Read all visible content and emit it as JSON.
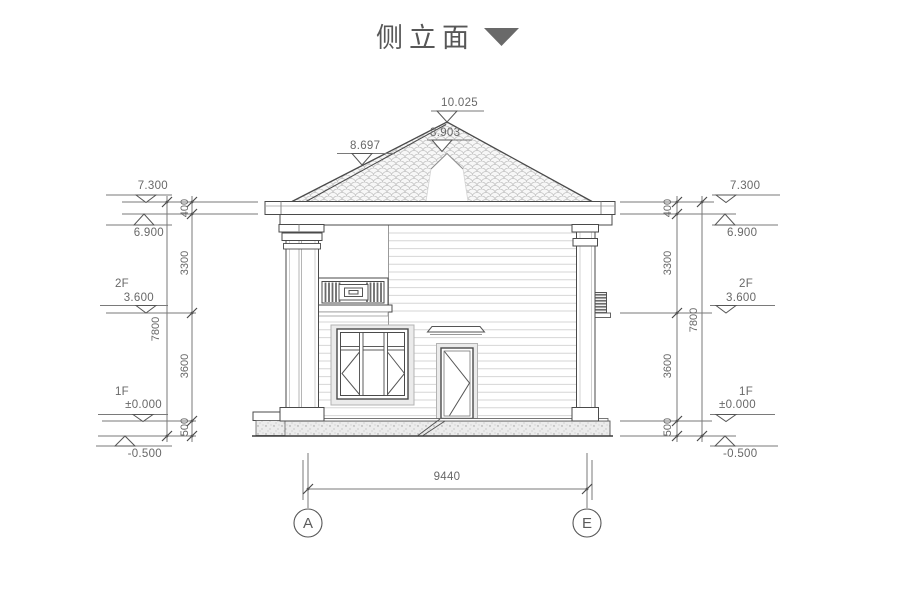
{
  "title": {
    "text": "侧立面"
  },
  "roof_markers": {
    "peak": "10.025",
    "ridge": "8.903",
    "slope": "8.697"
  },
  "markers": {
    "left": {
      "lvl_parapet": "7.300",
      "lvl_eave": "6.900",
      "floor2_label": "2F",
      "lvl_floor2": "3.600",
      "floor1_label": "1F",
      "lvl_floor1": "±0.000",
      "lvl_ground": "-0.500"
    },
    "right": {
      "lvl_parapet": "7.300",
      "lvl_eave": "6.900",
      "floor2_label": "2F",
      "lvl_floor2": "3.600",
      "floor1_label": "1F",
      "lvl_floor1": "±0.000",
      "lvl_ground": "-0.500"
    }
  },
  "dimensions": {
    "left": {
      "s1": "400",
      "s2": "3300",
      "s3": "3600",
      "s4": "500",
      "total": "7800"
    },
    "right": {
      "s1": "400",
      "s2": "3300",
      "s3": "3600",
      "s4": "500",
      "total": "7800"
    },
    "bottom": {
      "span": "9440"
    }
  },
  "grid": {
    "a": "A",
    "e": "E"
  },
  "colors": {
    "line": "#4a4a4a",
    "dim_line": "#777777",
    "dim_text": "#686868",
    "title_text": "#575757",
    "title_triangle": "#696969",
    "siding": "#d6d6d6",
    "shingle": "#c4c4c4"
  }
}
